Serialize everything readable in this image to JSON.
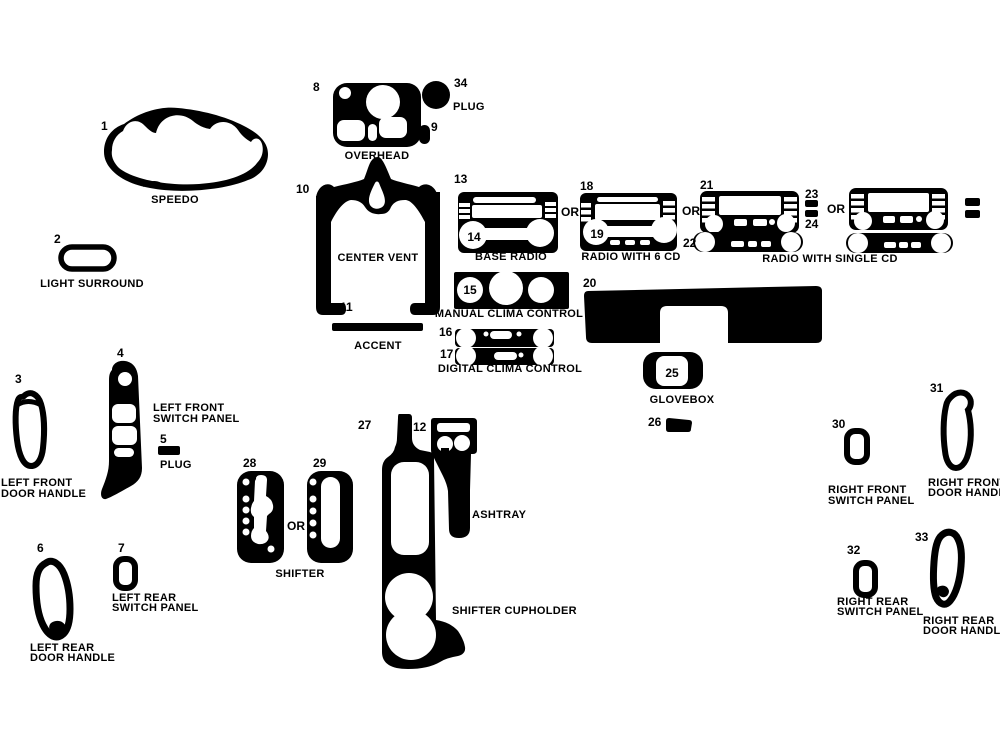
{
  "colors": {
    "ink": "#000000",
    "background": "#ffffff"
  },
  "or_label": "OR",
  "parts": {
    "speedo": {
      "num": "1",
      "label": "SPEEDO"
    },
    "light_surround": {
      "num": "2",
      "label": "LIGHT SURROUND"
    },
    "lf_door": {
      "num": "3",
      "line1": "LEFT FRONT",
      "line2": "DOOR HANDLE"
    },
    "lf_switch": {
      "num": "4",
      "line1": "LEFT FRONT",
      "line2": "SWITCH PANEL"
    },
    "plug5": {
      "num": "5",
      "label": "PLUG"
    },
    "lr_door": {
      "num": "6",
      "line1": "LEFT REAR",
      "line2": "DOOR HANDLE"
    },
    "lr_switch": {
      "num": "7",
      "line1": "LEFT REAR",
      "line2": "SWITCH PANEL"
    },
    "overhead": {
      "num": "8",
      "label": "OVERHEAD"
    },
    "plug9": {
      "num": "9"
    },
    "center_vent": {
      "num": "10",
      "label": "CENTER VENT"
    },
    "accent": {
      "num": "11",
      "label": "ACCENT"
    },
    "ashtray": {
      "num": "12",
      "label": "ASHTRAY"
    },
    "base_radio": {
      "num": "13",
      "num2": "14",
      "label": "BASE RADIO"
    },
    "manual_clima": {
      "num": "15",
      "label": "MANUAL CLIMA CONTROL"
    },
    "digital_clima": {
      "num1": "16",
      "num2": "17",
      "label": "DIGITAL CLIMA CONTROL"
    },
    "radio_6cd": {
      "num": "18",
      "num2": "19",
      "label": "RADIO WITH 6 CD"
    },
    "dash_panel": {
      "num": "20"
    },
    "radio_single": {
      "num1": "21",
      "num2": "22",
      "num3": "23",
      "num4": "24",
      "label": "RADIO WITH SINGLE CD"
    },
    "glovebox": {
      "num": "25",
      "label": "GLOVEBOX"
    },
    "bin26": {
      "num": "26"
    },
    "console": {
      "num": "27",
      "label": "SHIFTER CUPHOLDER"
    },
    "shifter": {
      "num1": "28",
      "num2": "29",
      "label": "SHIFTER"
    },
    "rf_switch": {
      "num": "30",
      "line1": "RIGHT FRONT",
      "line2": "SWITCH PANEL"
    },
    "rf_door": {
      "num": "31",
      "line1": "RIGHT FRONT",
      "line2": "DOOR HANDLE"
    },
    "rr_switch": {
      "num": "32",
      "line1": "RIGHT REAR",
      "line2": "SWITCH PANEL"
    },
    "rr_door": {
      "num": "33",
      "line1": "RIGHT REAR",
      "line2": "DOOR HANDLE"
    },
    "plug34": {
      "num": "34",
      "label": "PLUG"
    }
  }
}
